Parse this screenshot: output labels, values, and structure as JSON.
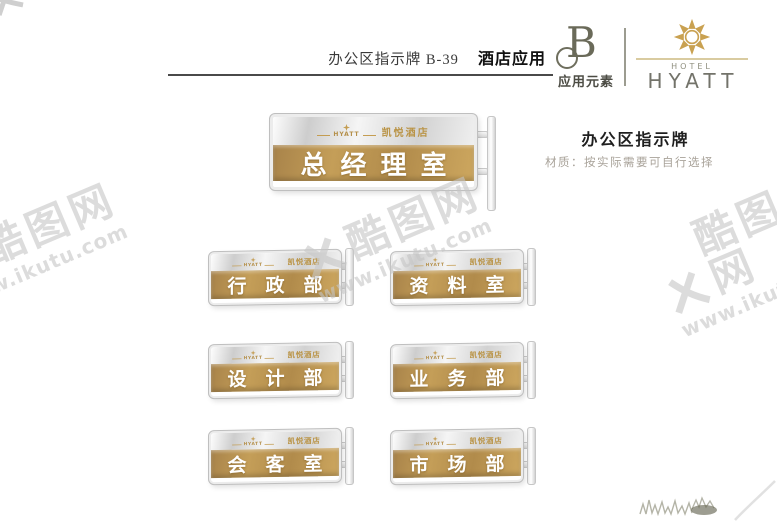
{
  "header": {
    "doc_code": "办公区指示牌 B-39",
    "doc_title": "酒店应用",
    "element_mark": "B",
    "element_label": "应用元素",
    "brand": {
      "hotel": "HOTEL",
      "name": "HYATT"
    }
  },
  "emblem": {
    "brand": "HYATT",
    "hotel_cn": "凯悦酒店"
  },
  "signs": {
    "main": "总经理室",
    "grid": [
      "行政部",
      "资料室",
      "设计部",
      "业务部",
      "会客室",
      "市场部"
    ]
  },
  "info": {
    "title": "办公区指示牌",
    "material": "材质：按实际需要可自行选择"
  },
  "watermark": {
    "name": "酷图网",
    "url": "www.ikutu.com"
  },
  "colors": {
    "gold": "#b8914f",
    "gold_light": "#cfa75e",
    "silver": "#d6d6d6",
    "olive": "#6e6e5e",
    "brand_gold": "#c49d52"
  }
}
